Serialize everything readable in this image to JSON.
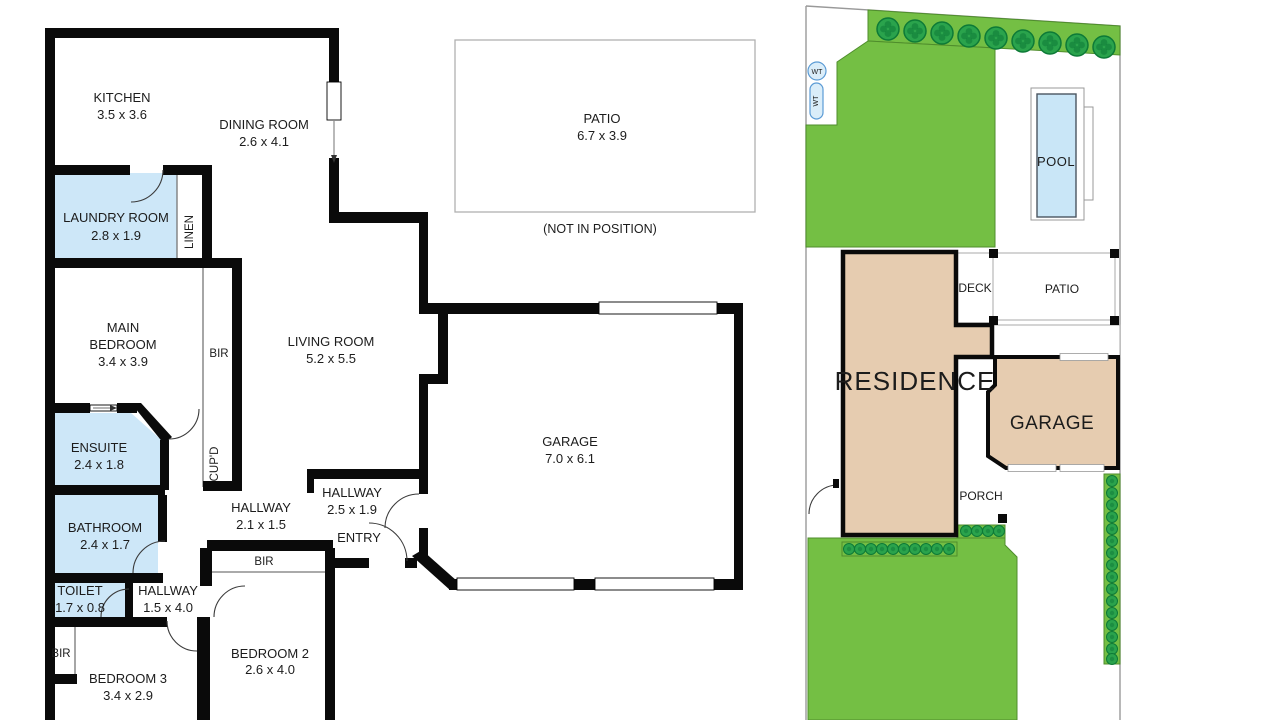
{
  "colors": {
    "wall": "#0a0a0a",
    "wet_area": "#cde7f8",
    "lawn": "#74bf44",
    "strip_border": "#4f8d2c",
    "shrub": "#2aa34c",
    "shrub_dark": "#0d7a37",
    "residence_fill": "#e6ccb0",
    "pool_water": "#c9e6f7",
    "tank_fill": "#daedf9",
    "boundary_gray": "#999999",
    "text": "#1c1c1c"
  },
  "plan": {
    "kitchen": {
      "name": "KITCHEN",
      "dims": "3.5 x 3.6"
    },
    "dining": {
      "name": "DINING ROOM",
      "dims": "2.6 x 4.1"
    },
    "patio": {
      "name": "PATIO",
      "dims": "6.7 x 3.9",
      "note": "(NOT IN POSITION)"
    },
    "laundry": {
      "name": "LAUNDRY ROOM",
      "dims": "2.8 x 1.9"
    },
    "linen": {
      "name": "LINEN"
    },
    "main_bedroom": {
      "line1": "MAIN",
      "line2": "BEDROOM",
      "dims": "3.4 x 3.9"
    },
    "bir_main": {
      "name": "BIR"
    },
    "living": {
      "name": "LIVING ROOM",
      "dims": "5.2 x 5.5"
    },
    "ensuite": {
      "name": "ENSUITE",
      "dims": "2.4 x 1.8"
    },
    "cupd": {
      "name": "CUP'D"
    },
    "bathroom": {
      "name": "BATHROOM",
      "dims": "2.4 x 1.7"
    },
    "toilet": {
      "name": "TOILET",
      "dims": "1.7 x 0.8"
    },
    "hall_mid": {
      "name": "HALLWAY",
      "dims": "2.1 x 1.5"
    },
    "hall_entry": {
      "name": "HALLWAY",
      "dims": "2.5 x 1.9"
    },
    "entry": {
      "name": "ENTRY"
    },
    "bir_bed2": {
      "name": "BIR"
    },
    "hall_bed": {
      "name": "HALLWAY",
      "dims": "1.5 x 4.0"
    },
    "bir_bed3": {
      "name": "BIR"
    },
    "bedroom3": {
      "name": "BEDROOM 3",
      "dims": "3.4 x 2.9"
    },
    "bedroom2": {
      "name": "BEDROOM 2",
      "dims": "2.6 x 4.0"
    },
    "garage": {
      "name": "GARAGE",
      "dims": "7.0 x 6.1"
    }
  },
  "site": {
    "residence": "RESIDENCE",
    "garage": "GARAGE",
    "deck": "DECK",
    "patio": "PATIO",
    "porch": "PORCH",
    "pool": "POOL",
    "water_tank_1": "WT",
    "water_tank_2": "WT"
  }
}
